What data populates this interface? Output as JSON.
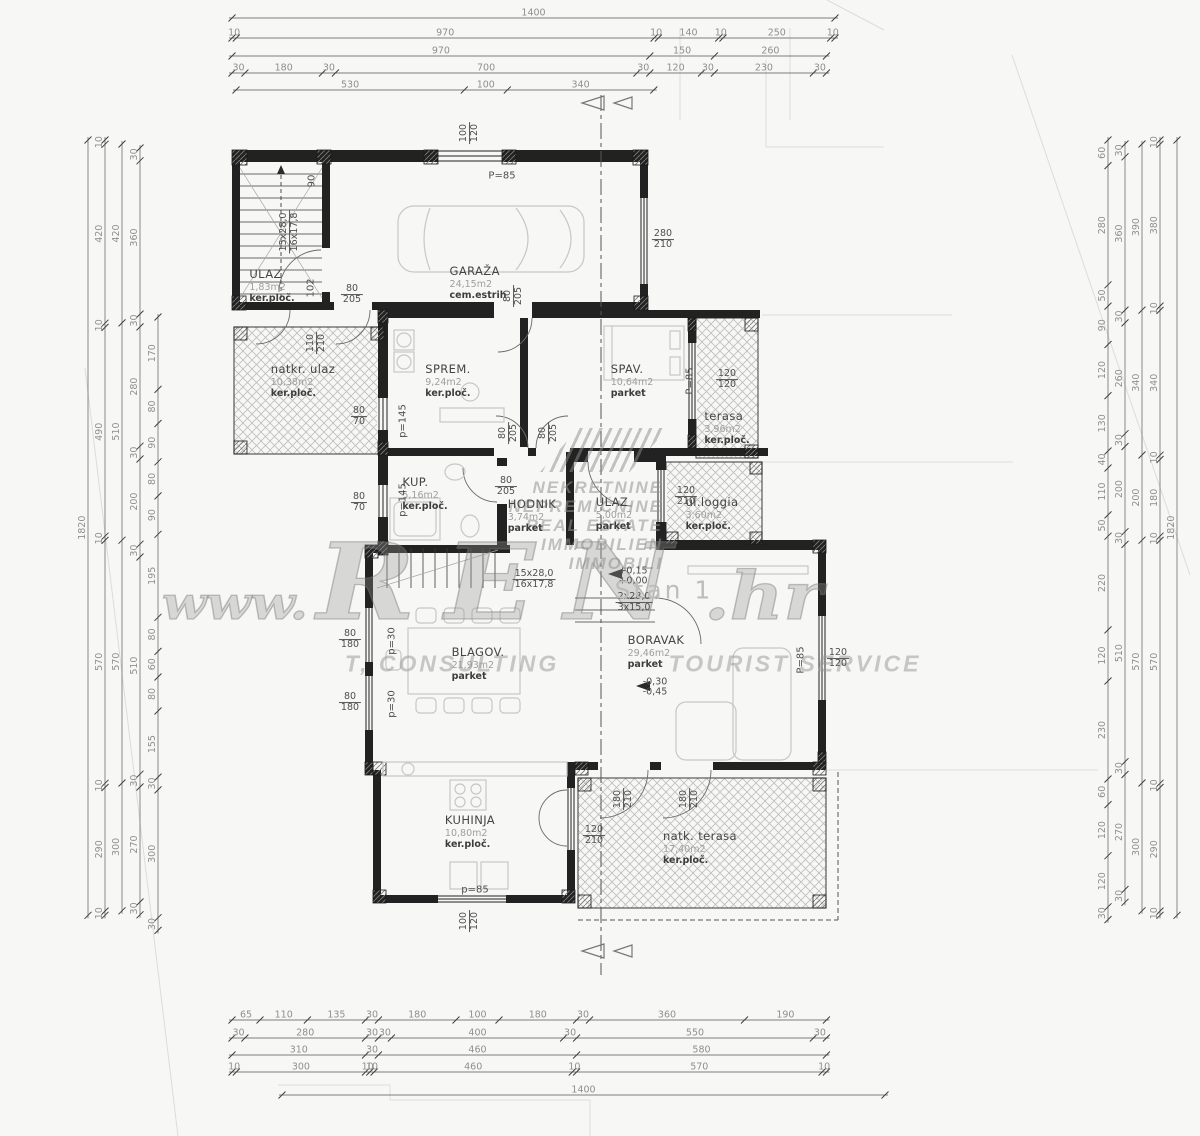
{
  "watermark": {
    "logo_lines": [
      "NEKRETNINE",
      "NEPREMIČNINE",
      "REAL ESTATE",
      "IMMOBILIEN",
      "IMMOBILI"
    ],
    "url_www": "www.",
    "url_name": "REN",
    "url_tld": ".hr",
    "tagline_left": "T, CONSULTING",
    "tagline_right": "TOURIST SERVICE"
  },
  "rooms": [
    {
      "name": "ULAZ",
      "area": "1,83m2",
      "floor": "ker.ploč.",
      "x": 272,
      "y": 286
    },
    {
      "name": "GARAŽA",
      "area": "24,15m2",
      "floor": "cem.estrih",
      "x": 478,
      "y": 283
    },
    {
      "name": "natkr. ulaz",
      "area": "10,38m2",
      "floor": "ker.ploč.",
      "x": 303,
      "y": 381
    },
    {
      "name": "SPREM.",
      "area": "9,24m2",
      "floor": "ker.ploč.",
      "x": 448,
      "y": 381
    },
    {
      "name": "SPAV.",
      "area": "10,64m2",
      "floor": "parket",
      "x": 632,
      "y": 381
    },
    {
      "name": "terasa",
      "area": "3,96m2",
      "floor": "ker.ploč.",
      "x": 727,
      "y": 428
    },
    {
      "name": "KUP.",
      "area": "5,16m2",
      "floor": "ker.ploč.",
      "x": 425,
      "y": 494
    },
    {
      "name": "HODNIK",
      "area": "3,74m2",
      "floor": "parket",
      "x": 532,
      "y": 516
    },
    {
      "name": "ULAZ",
      "area": "5,00m2",
      "floor": "parket",
      "x": 614,
      "y": 514
    },
    {
      "name": "ul.loggia",
      "area": "3,60m2",
      "floor": "ker.ploč.",
      "x": 712,
      "y": 514
    },
    {
      "name": "BLAGOV.",
      "area": "21,93m2",
      "floor": "parket",
      "x": 478,
      "y": 664
    },
    {
      "name": "BORAVAK",
      "area": "29,46m2",
      "floor": "parket",
      "x": 656,
      "y": 652
    },
    {
      "name": "KUHINJA",
      "area": "10,80m2",
      "floor": "ker.ploč.",
      "x": 470,
      "y": 832
    },
    {
      "name": "natk. terasa",
      "area": "17,40m2",
      "floor": "ker.ploč.",
      "x": 700,
      "y": 848
    }
  ],
  "openings": [
    {
      "top": "100",
      "bottom": "120",
      "x": 470,
      "y": 133,
      "rot": true
    },
    {
      "top": "280",
      "bottom": "210",
      "x": 663,
      "y": 240
    },
    {
      "top": "80",
      "bottom": "205",
      "x": 352,
      "y": 295
    },
    {
      "top": "80",
      "bottom": "205",
      "x": 514,
      "y": 296,
      "rot": true
    },
    {
      "top": "110",
      "bottom": "210",
      "x": 317,
      "y": 343,
      "rot": true
    },
    {
      "top": "80",
      "bottom": "70",
      "x": 359,
      "y": 417
    },
    {
      "top": "120",
      "bottom": "120",
      "x": 727,
      "y": 380
    },
    {
      "top": "80",
      "bottom": "205",
      "x": 509,
      "y": 433,
      "rot": true
    },
    {
      "top": "80",
      "bottom": "205",
      "x": 549,
      "y": 433,
      "rot": true
    },
    {
      "top": "80",
      "bottom": "70",
      "x": 359,
      "y": 503
    },
    {
      "top": "80",
      "bottom": "205",
      "x": 506,
      "y": 487
    },
    {
      "top": "120",
      "bottom": "210",
      "x": 686,
      "y": 497
    },
    {
      "top": "120",
      "bottom": "120",
      "x": 838,
      "y": 659
    },
    {
      "top": "80",
      "bottom": "180",
      "x": 350,
      "y": 640
    },
    {
      "top": "80",
      "bottom": "180",
      "x": 350,
      "y": 703
    },
    {
      "top": "120",
      "bottom": "210",
      "x": 594,
      "y": 836
    },
    {
      "top": "180",
      "bottom": "210",
      "x": 624,
      "y": 799,
      "rot": true
    },
    {
      "top": "180",
      "bottom": "210",
      "x": 690,
      "y": 799,
      "rot": true
    },
    {
      "top": "100",
      "bottom": "120",
      "x": 470,
      "y": 921,
      "rot": true
    },
    {
      "top": "15x28,0",
      "bottom": "16x17,8",
      "x": 290,
      "y": 232,
      "rot": true
    },
    {
      "top": "15x28,0",
      "bottom": "16x17,8",
      "x": 534,
      "y": 580
    },
    {
      "top": "2x28,0",
      "bottom": "3x15,0",
      "x": 634,
      "y": 603
    },
    {
      "top": "+0,15",
      "bottom": "+0,00",
      "x": 633,
      "y": 577,
      "line": false
    },
    {
      "top": "-0,30",
      "bottom": "-0,45",
      "x": 655,
      "y": 688,
      "line": false
    }
  ],
  "texts": [
    {
      "t": "P=85",
      "x": 502,
      "y": 176,
      "name": "window-parapet-label"
    },
    {
      "t": "P=85",
      "x": 690,
      "y": 381,
      "rot": true,
      "name": "window-parapet-label"
    },
    {
      "t": "P=85",
      "x": 801,
      "y": 660,
      "rot": true,
      "name": "window-parapet-label"
    },
    {
      "t": "p=145",
      "x": 403,
      "y": 421,
      "rot": true,
      "name": "window-parapet-label"
    },
    {
      "t": "p=145",
      "x": 403,
      "y": 500,
      "rot": true,
      "name": "window-parapet-label"
    },
    {
      "t": "p=30",
      "x": 392,
      "y": 641,
      "rot": true,
      "name": "window-parapet-label"
    },
    {
      "t": "p=30",
      "x": 392,
      "y": 704,
      "rot": true,
      "name": "window-parapet-label"
    },
    {
      "t": "p=85",
      "x": 475,
      "y": 890,
      "name": "window-parapet-label"
    },
    {
      "t": "90",
      "x": 312,
      "y": 181,
      "rot": true,
      "name": "dim-note"
    },
    {
      "t": "102",
      "x": 311,
      "y": 288,
      "rot": true,
      "name": "dim-note"
    },
    {
      "t": "Stan 1",
      "x": 664,
      "y": 590,
      "cls": "stan",
      "name": "unit-label"
    }
  ],
  "dims": {
    "h_scale": 0.4307,
    "v_scale": 0.426,
    "h_rows": [
      {
        "y": 18,
        "x0": 232,
        "segs": [
          1400
        ]
      },
      {
        "y": 38,
        "x0": 232,
        "segs": [
          10,
          970,
          10,
          140,
          10,
          250,
          10
        ]
      },
      {
        "y": 56,
        "x0": 232,
        "segs": [
          970,
          150,
          260
        ]
      },
      {
        "y": 73,
        "x0": 232,
        "segs": [
          30,
          180,
          30,
          700,
          30,
          120,
          30,
          230,
          30
        ]
      },
      {
        "y": 90,
        "x0": 236,
        "segs": [
          530,
          100,
          340
        ]
      },
      {
        "y": 1020,
        "x0": 232,
        "segs": [
          65,
          110,
          135,
          30,
          180,
          100,
          180,
          30,
          360,
          190
        ]
      },
      {
        "y": 1038,
        "x0": 232,
        "segs": [
          30,
          280,
          30,
          30,
          400,
          30,
          550,
          30
        ]
      },
      {
        "y": 1055,
        "x0": 232,
        "segs": [
          310,
          30,
          460,
          580
        ]
      },
      {
        "y": 1072,
        "x0": 232,
        "segs": [
          10,
          300,
          10,
          10,
          460,
          10,
          570,
          10
        ]
      },
      {
        "y": 1095,
        "x0": 282,
        "segs": [
          1400
        ]
      }
    ],
    "v_cols": [
      {
        "x": 88,
        "y0": 140,
        "segs": [
          1820
        ]
      },
      {
        "x": 105,
        "y0": 140,
        "segs": [
          10,
          420,
          10,
          490,
          10,
          570,
          10,
          290,
          10
        ]
      },
      {
        "x": 122,
        "y0": 144,
        "segs": [
          420,
          510,
          570,
          300
        ]
      },
      {
        "x": 140,
        "y0": 148,
        "segs": [
          30,
          360,
          30,
          280,
          30,
          200,
          30,
          510,
          30,
          270,
          30
        ]
      },
      {
        "x": 158,
        "y0": 317,
        "segs": [
          170,
          80,
          90,
          80,
          90,
          195,
          80,
          60,
          80,
          155,
          30,
          300,
          30
        ]
      },
      {
        "x": 1108,
        "y0": 140,
        "segs": [
          60,
          280,
          50,
          90,
          120,
          130,
          40,
          110,
          50,
          220,
          120,
          230,
          60,
          120,
          120,
          30
        ]
      },
      {
        "x": 1125,
        "y0": 144,
        "segs": [
          30,
          360,
          30,
          260,
          30,
          200,
          30,
          510,
          30,
          270,
          30
        ]
      },
      {
        "x": 1142,
        "y0": 144,
        "segs": [
          390,
          340,
          200,
          570,
          300
        ]
      },
      {
        "x": 1160,
        "y0": 140,
        "segs": [
          10,
          380,
          10,
          340,
          10,
          180,
          10,
          570,
          10,
          290,
          10
        ]
      },
      {
        "x": 1177,
        "y0": 140,
        "segs": [
          1820
        ]
      }
    ]
  }
}
